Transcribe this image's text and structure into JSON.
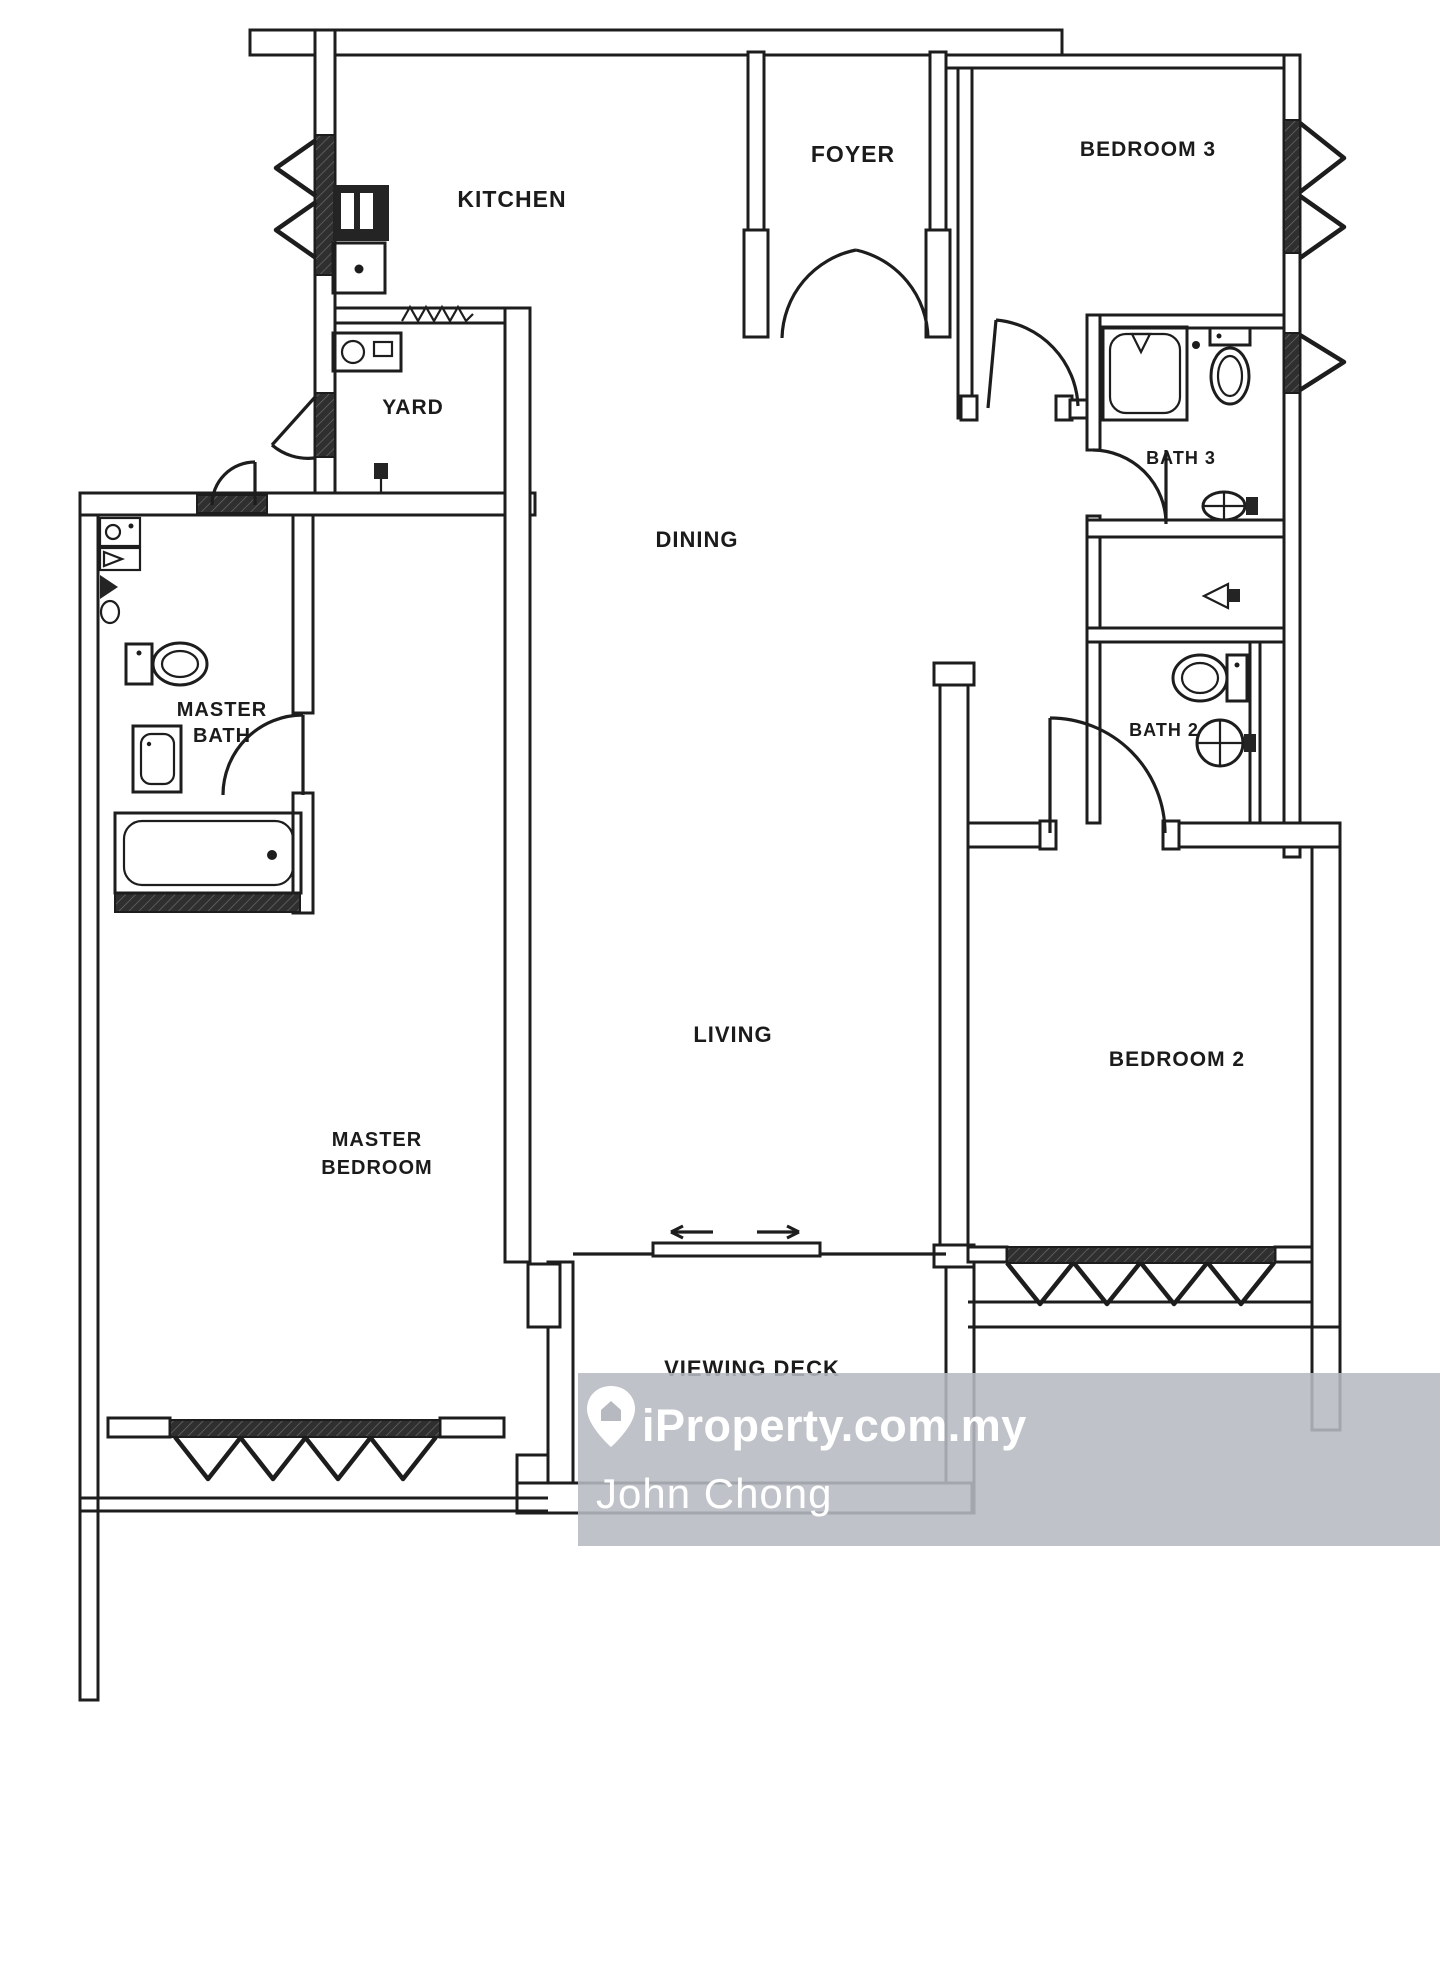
{
  "rooms": {
    "kitchen": {
      "label": "KITCHEN"
    },
    "foyer": {
      "label": "FOYER"
    },
    "bedroom3": {
      "label": "BEDROOM 3"
    },
    "yard": {
      "label": "YARD"
    },
    "dining": {
      "label": "DINING"
    },
    "bath3": {
      "label": "BATH 3"
    },
    "master_bath": {
      "label_line1": "MASTER",
      "label_line2": "BATH"
    },
    "bath2": {
      "label": "BATH 2"
    },
    "living": {
      "label": "LIVING"
    },
    "master_bedroom": {
      "label_line1": "MASTER",
      "label_line2": "BEDROOM"
    },
    "bedroom2": {
      "label": "BEDROOM 2"
    },
    "viewing_deck": {
      "label": "VIEWING DECK"
    }
  },
  "watermark": {
    "brand": "iProperty.com.my",
    "agent": "John Chong",
    "icon": "location-pin-icon",
    "bg_color": "#b6bac0",
    "text_color": "#ffffff"
  },
  "colors": {
    "line": "#1d1d1d",
    "paper": "#ffffff"
  }
}
